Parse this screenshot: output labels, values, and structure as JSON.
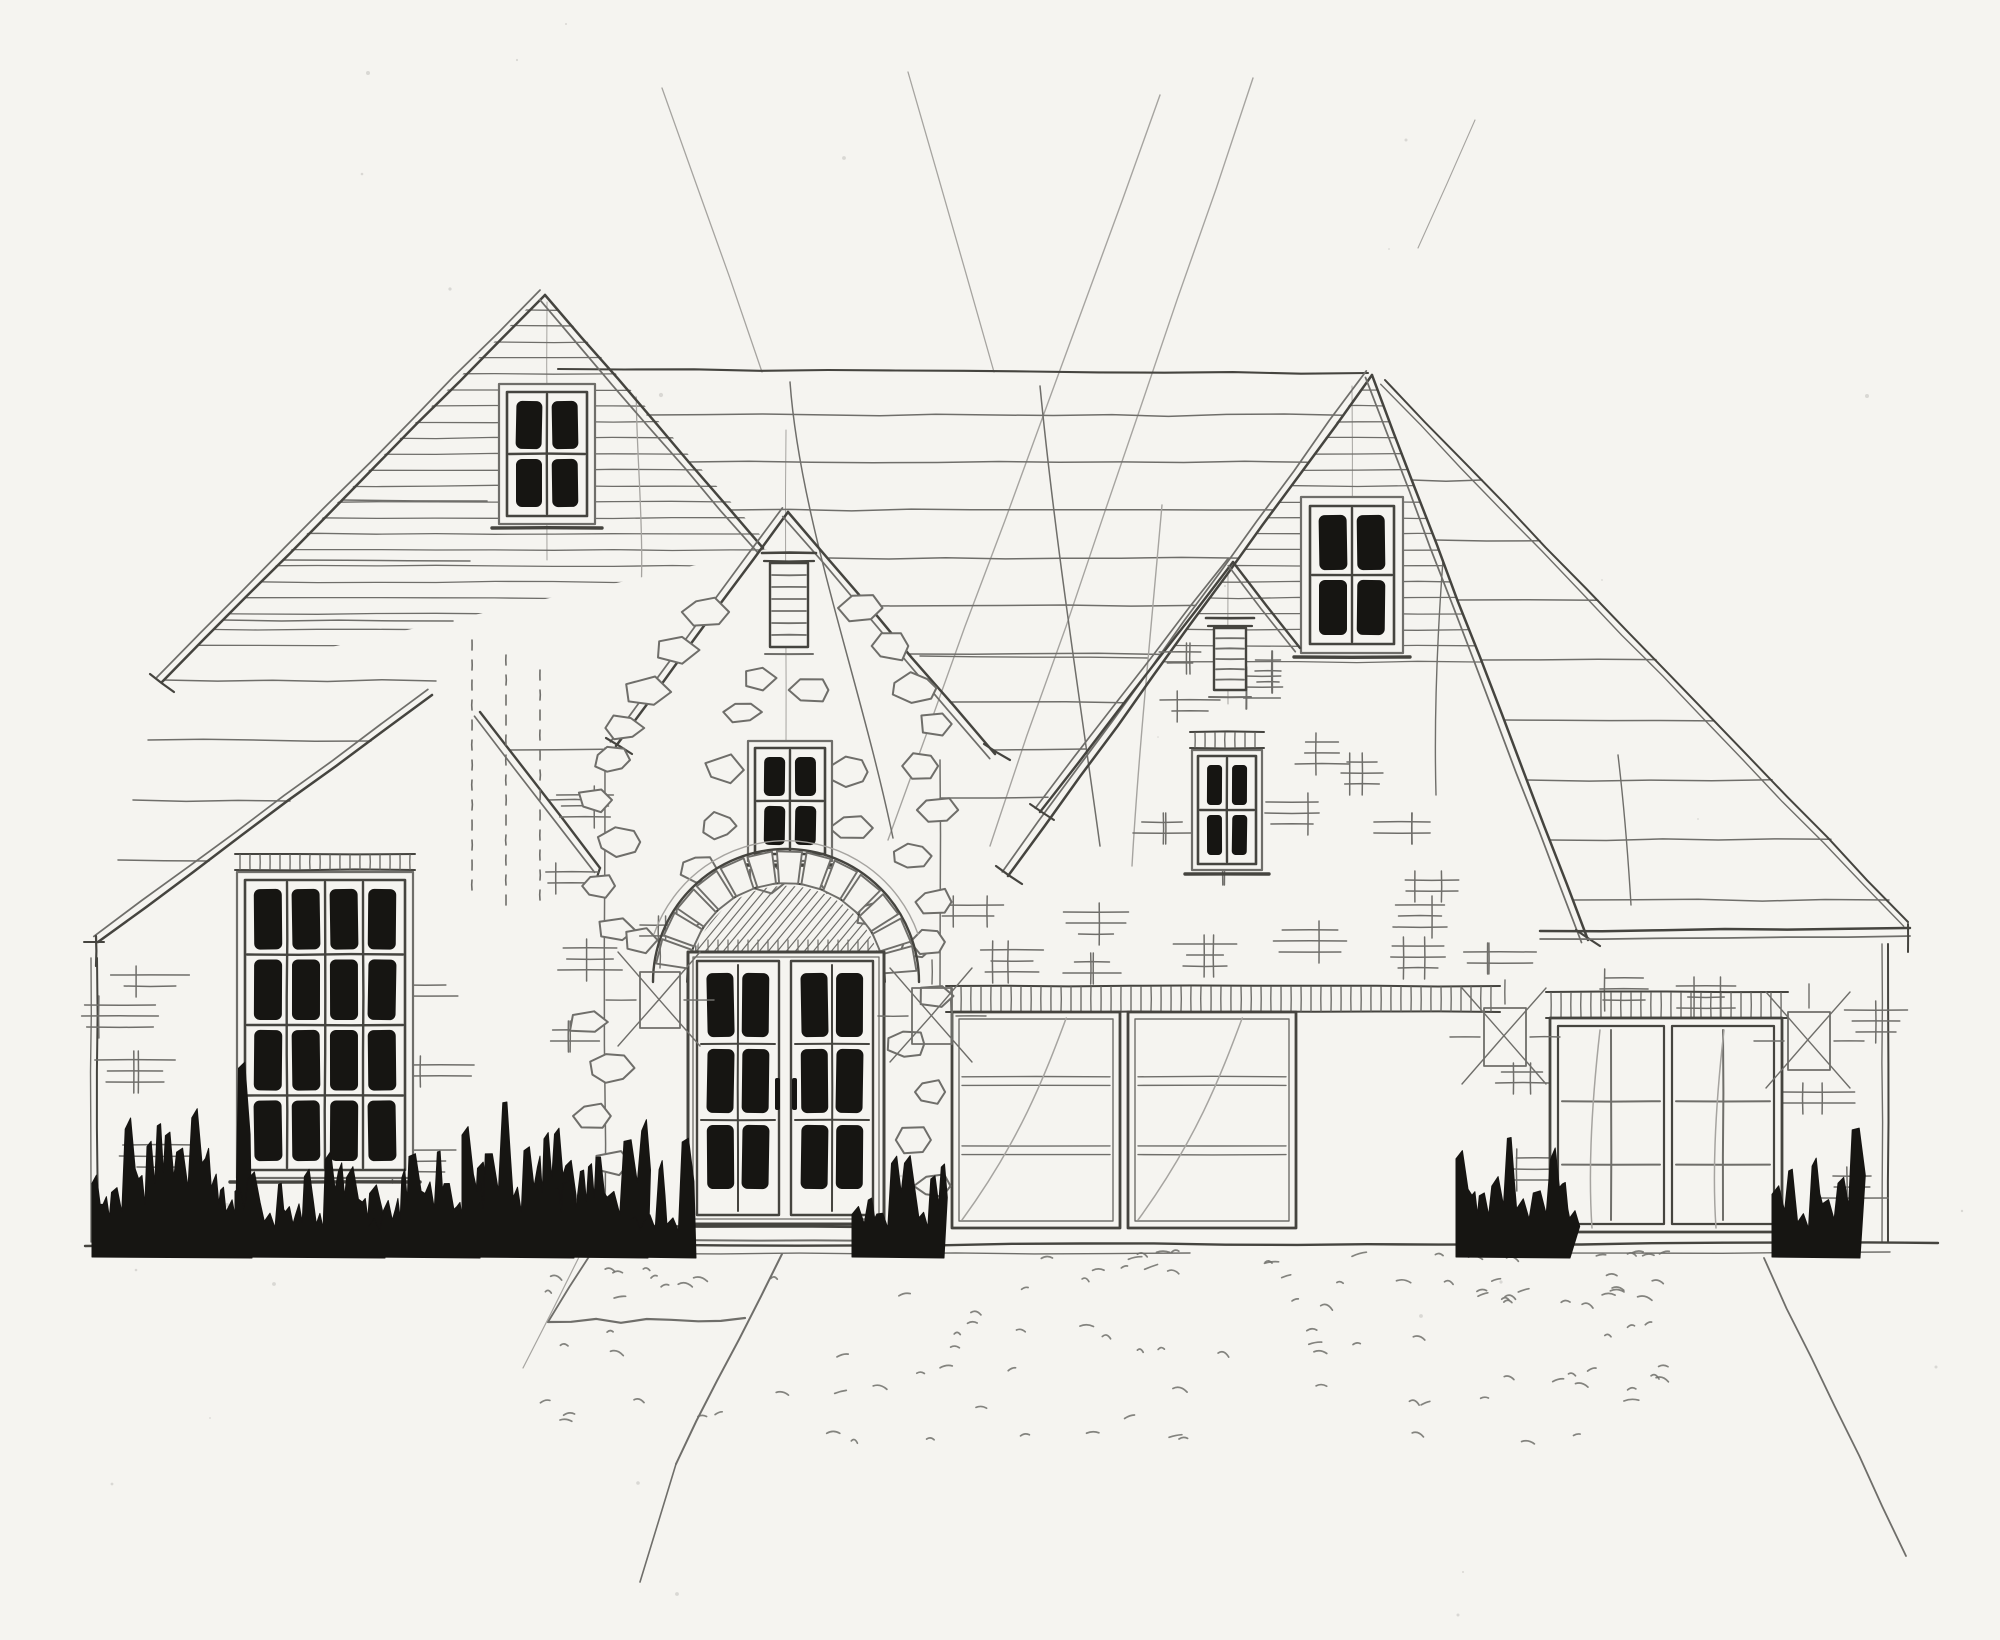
{
  "scene": {
    "title": "Hand-drawn architectural front elevation sketch of a single-family house",
    "medium": "pencil line work with black ink accents on white paper",
    "style": "freehand builder's concept elevation, no text or dimensions"
  },
  "colors": {
    "paper": "#f5f4f0",
    "pencil_light": "#a6a4a0",
    "pencil": "#6f6e6a",
    "pencil_dark": "#45443f",
    "ink": "#161512"
  },
  "elevation": {
    "sections": [
      {
        "id": "left-wing",
        "label": "low left brick wing with tall multi-pane window"
      },
      {
        "id": "left-gable",
        "label": "tall left gable with horizontal siding and attic window"
      },
      {
        "id": "center-gable",
        "label": "central stone gable with louver vent, window and arched entry"
      },
      {
        "id": "small-gable",
        "label": "small brick gable with louver vent and window"
      },
      {
        "id": "right-gable",
        "label": "tall right gable with horizontal siding and attic window"
      },
      {
        "id": "garage-wing",
        "label": "brick garage wing with double garage and single garage"
      }
    ],
    "windows": [
      {
        "id": "left-gable-window",
        "cols": 2,
        "rows": 2,
        "dark_glass": true
      },
      {
        "id": "left-wing-window",
        "cols": 4,
        "rows": 4,
        "dark_glass": true,
        "soldier_course": true
      },
      {
        "id": "center-gable-window",
        "cols": 2,
        "rows": 2,
        "dark_glass": true
      },
      {
        "id": "small-gable-window",
        "cols": 2,
        "rows": 2,
        "dark_glass": true,
        "soldier_course": true
      },
      {
        "id": "right-gable-window",
        "cols": 2,
        "rows": 2,
        "dark_glass": true
      }
    ],
    "louver_vents": [
      {
        "id": "center-gable-louver",
        "slats": 6
      },
      {
        "id": "small-gable-louver",
        "slats": 5
      }
    ],
    "entry_door": {
      "leaves": 2,
      "pane_grid_per_leaf": {
        "cols": 2,
        "rows": 3
      },
      "surround": "rough stone jambs with voussoir arch and hatched transom",
      "step": true
    },
    "garage_doors": [
      {
        "id": "double-garage-left-door",
        "panel_lines": 2
      },
      {
        "id": "double-garage-right-door",
        "panel_lines": 2
      },
      {
        "id": "single-garage-door",
        "leaves": 2,
        "panel_grid_per_leaf": {
          "cols": 2,
          "rows": 3
        }
      }
    ],
    "masonry": {
      "stone": "irregular fieldstone outlines on center gable and entry surround",
      "brick": "short dash-and-tick brick clusters on walls",
      "lintels": "soldier-course tick bands above garage doors and windows"
    },
    "landscaping": {
      "bush_clusters": 9,
      "bush_style": "solid black ink jagged silhouettes",
      "driveway": "stippled dash texture",
      "walkway": "tapering path from entry step"
    },
    "annotations": {
      "lantern_x_marks": 4,
      "construction_lines": "long faint diagonal and curved layout strokes across roof and sky",
      "ridge_line": true,
      "ground_line": true
    }
  }
}
